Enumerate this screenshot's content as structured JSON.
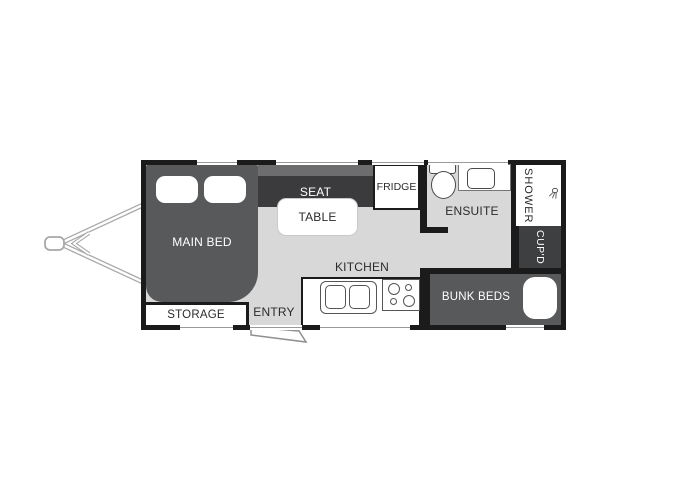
{
  "floorplan": {
    "type": "caravan-floor-plan",
    "rooms": {
      "main_bed": "MAIN BED",
      "storage": "STORAGE",
      "entry": "ENTRY",
      "seat": "SEAT",
      "table": "TABLE",
      "fridge": "FRIDGE",
      "kitchen": "KITCHEN",
      "ensuite": "ENSUITE",
      "shower": "SHOWER",
      "cupboard": "CUP'D",
      "bunk_beds": "BUNK BEDS"
    },
    "icons": {
      "shower_head": "shower-head-icon"
    },
    "colors": {
      "wall": "#1b1b1b",
      "floor": "#d8d8d8",
      "furniture_dark": "#58595b",
      "seat_dark": "#3b3b3d",
      "seat_back": "#6d6d6f",
      "cupboard_dark": "#3e3f41",
      "hitch_gray": "#a8a8a8",
      "text_dark": "#2b2b2b",
      "text_light": "#ffffff"
    }
  }
}
